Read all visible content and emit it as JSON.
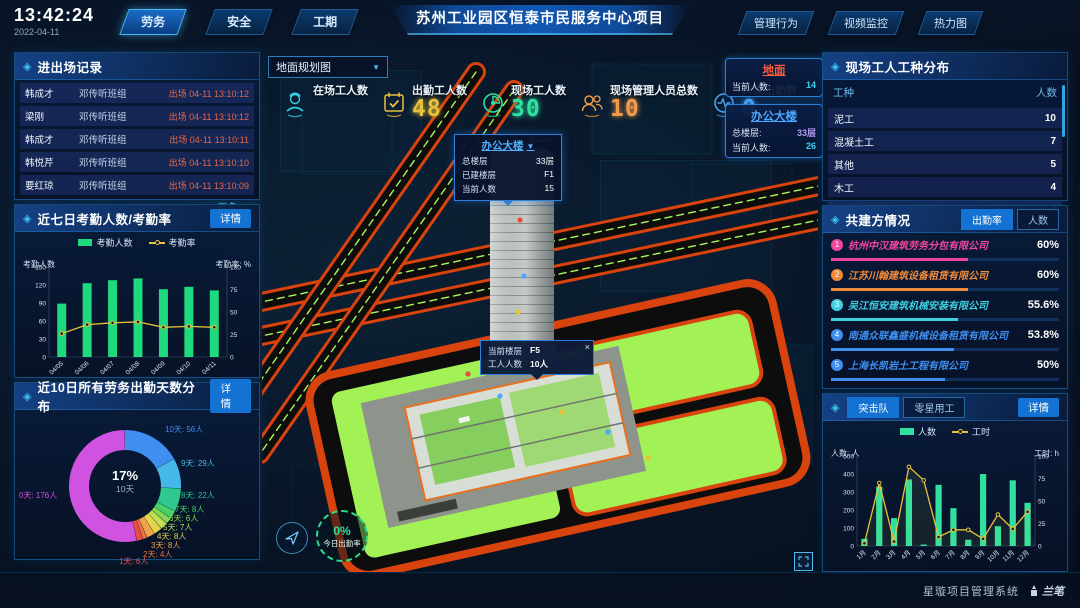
{
  "ui": {
    "panel_icon": "◈",
    "caret": "▼",
    "close": "×"
  },
  "header": {
    "time": "13:42:24",
    "date": "2022-04-11",
    "nav_left": [
      "劳务",
      "安全",
      "工期"
    ],
    "active_left_tab": "劳务",
    "title": "苏州工业园区恒泰市民服务中心项目",
    "nav_right": [
      "管理行为",
      "视频监控",
      "热力图"
    ]
  },
  "entry_exit": {
    "title": "进出场记录",
    "rows": [
      {
        "name": "韩成才",
        "team": "邓传听班组",
        "event": "出场 04-11 13:10:12"
      },
      {
        "name": "梁刚",
        "team": "邓传听班组",
        "event": "出场 04-11 13:10:12"
      },
      {
        "name": "韩成才",
        "team": "邓传听班组",
        "event": "出场 04-11 13:10:11"
      },
      {
        "name": "韩悦芹",
        "team": "邓传听班组",
        "event": "出场 04-11 13:10:10"
      },
      {
        "name": "要红琼",
        "team": "邓传听班组",
        "event": "出场 04-11 13:10:09"
      }
    ],
    "more_label": "更多>>"
  },
  "attendance_panel": {
    "title": "近七日考勤人数/考勤率",
    "detail_label": "详情"
  },
  "distribution_panel": {
    "title": "近10日所有劳务出勤天数分布",
    "detail_label": "详情"
  },
  "worker_types": {
    "title": "现场工人工种分布",
    "headers": {
      "type": "工种",
      "count": "人数"
    },
    "rows": [
      {
        "type": "泥工",
        "count": "10"
      },
      {
        "type": "混凝土工",
        "count": "7"
      },
      {
        "type": "其他",
        "count": "5"
      },
      {
        "type": "木工",
        "count": "4"
      },
      {
        "type": "塔司",
        "count": "4"
      }
    ]
  },
  "partners": {
    "title": "共建方情况",
    "tabs": [
      "出勤率",
      "人数"
    ],
    "active_tab": "出勤率",
    "companies": [
      {
        "rank": "1",
        "name": "杭州中汉建筑劳务分包有限公司",
        "pct": "60%",
        "value": 60,
        "color": "#f0479c"
      },
      {
        "rank": "2",
        "name": "江苏川翰建筑设备租赁有限公司",
        "pct": "60%",
        "value": 60,
        "color": "#f08b3c"
      },
      {
        "rank": "3",
        "name": "吴江恒安建筑机械安装有限公司",
        "pct": "55.6%",
        "value": 55.6,
        "color": "#3fd0e0"
      },
      {
        "rank": "4",
        "name": "南通众联鑫盛机械设备租赁有限公司",
        "pct": "53.8%",
        "value": 53.8,
        "color": "#3f8ef0"
      },
      {
        "rank": "5",
        "name": "上海长凯岩土工程有限公司",
        "pct": "50%",
        "value": 50,
        "color": "#3f8ef0"
      },
      {
        "rank": "6",
        "name": "江苏洁尚建筑安装工程有限公司",
        "pct": "35.4%",
        "value": 35.4,
        "color": "#8a5af0"
      }
    ]
  },
  "assault_panel": {
    "tabs": [
      "突击队",
      "零星用工"
    ],
    "active_tab": "突击队",
    "detail_label": "详情"
  },
  "map": {
    "dropdown_label": "地面规划图",
    "stats": [
      {
        "label": "在场工人数",
        "value": "",
        "color": "#35d0e0",
        "icon": "worker-icon"
      },
      {
        "label": "出勤工人数",
        "value": "48",
        "color": "#e8c23a",
        "icon": "calendar-check-icon"
      },
      {
        "label": "现场工人数",
        "value": "30",
        "color": "#2fe0a0",
        "icon": "gauge-icon"
      },
      {
        "label": "现场管理人员总数",
        "value": "10",
        "color": "#f09a4a",
        "icon": "people-icon"
      },
      {
        "label": "异常出勤数",
        "value": "0",
        "color": "#4aa8f0",
        "icon": "pulse-icon"
      }
    ],
    "ground_panel": {
      "title": "地面",
      "current_label": "当前人数:",
      "current_value": "14"
    },
    "building_panel": {
      "title": "办公大楼",
      "floors_label": "总楼层:",
      "floors_value": "33层",
      "current_label": "当前人数:",
      "current_value": "26"
    },
    "tooltip_building": {
      "title": "办公大楼",
      "rows": [
        {
          "label": "总楼层",
          "value": "33层"
        },
        {
          "label": "已建楼层",
          "value": "F1"
        },
        {
          "label": "当前人数",
          "value": "15"
        }
      ]
    },
    "tooltip_floor": {
      "rows": [
        {
          "label": "当前楼层",
          "value": "F5"
        },
        {
          "label": "工人人数",
          "value": "10人"
        }
      ]
    },
    "rate_badge": {
      "pct": "0%",
      "label": "今日出勤率"
    }
  },
  "footer": {
    "brand": "星璇项目管理系统",
    "logo_text": "兰笔"
  },
  "chart_data": [
    {
      "id": "attendance",
      "type": "bar+line",
      "title": "近七日考勤人数/考勤率",
      "categories": [
        "04/05",
        "04/06",
        "04/07",
        "04/08",
        "04/09",
        "04/10",
        "04/11"
      ],
      "series": [
        {
          "name": "考勤人数",
          "type": "bar",
          "values": [
            89,
            123,
            128,
            131,
            113,
            117,
            111
          ],
          "color": "#1fd97e"
        },
        {
          "name": "考勤率",
          "type": "line",
          "values": [
            26,
            36,
            38,
            39,
            33,
            34,
            33
          ],
          "color": "#e8c23a"
        }
      ],
      "y_left": {
        "label": "考勤人数",
        "min": 0,
        "max": 150,
        "ticks": [
          0,
          30,
          60,
          90,
          120,
          150
        ]
      },
      "y_right": {
        "label": "考勤率: %",
        "min": 0,
        "max": 100,
        "ticks": [
          0,
          25,
          50,
          75,
          100
        ]
      }
    },
    {
      "id": "attendance_days",
      "type": "donut",
      "title": "近10日所有劳务出勤天数分布",
      "center": {
        "pct": "17%",
        "label": "10天"
      },
      "unit": "人",
      "slices": [
        {
          "name": "10天",
          "value": 56,
          "color": "#3f8ef0"
        },
        {
          "name": "9天",
          "value": 29,
          "color": "#46b8e8"
        },
        {
          "name": "8天",
          "value": 22,
          "color": "#2fc98f"
        },
        {
          "name": "7天",
          "value": 8,
          "color": "#47d066"
        },
        {
          "name": "6天",
          "value": 6,
          "color": "#85d952"
        },
        {
          "name": "5天",
          "value": 7,
          "color": "#bfdf55"
        },
        {
          "name": "4天",
          "value": 8,
          "color": "#e4d44a"
        },
        {
          "name": "3天",
          "value": 8,
          "color": "#eda44a"
        },
        {
          "name": "2天",
          "value": 4,
          "color": "#ed7442"
        },
        {
          "name": "1天",
          "value": 6,
          "color": "#e84c42"
        },
        {
          "name": "0天",
          "value": 176,
          "color": "#cf53e0"
        }
      ]
    },
    {
      "id": "assault",
      "type": "bar+line",
      "title": "突击队",
      "categories": [
        "1月",
        "2月",
        "3月",
        "4月",
        "5月",
        "6月",
        "7月",
        "8月",
        "9月",
        "10月",
        "11月",
        "12月"
      ],
      "series": [
        {
          "name": "人数",
          "type": "bar",
          "values": [
            40,
            330,
            155,
            370,
            8,
            340,
            210,
            35,
            400,
            110,
            365,
            240
          ],
          "color": "#2fe0a0"
        },
        {
          "name": "工时",
          "type": "line",
          "values": [
            3,
            70,
            5,
            88,
            73,
            10,
            18,
            18,
            8,
            35,
            19,
            38
          ],
          "color": "#e8c23a"
        }
      ],
      "y_left": {
        "label": "人数: 人",
        "min": 0,
        "max": 500,
        "ticks": [
          0,
          100,
          200,
          300,
          400,
          500
        ]
      },
      "y_right": {
        "label": "工时: h",
        "min": 0,
        "max": 100,
        "ticks": [
          0,
          25,
          50,
          75,
          100
        ]
      }
    }
  ]
}
